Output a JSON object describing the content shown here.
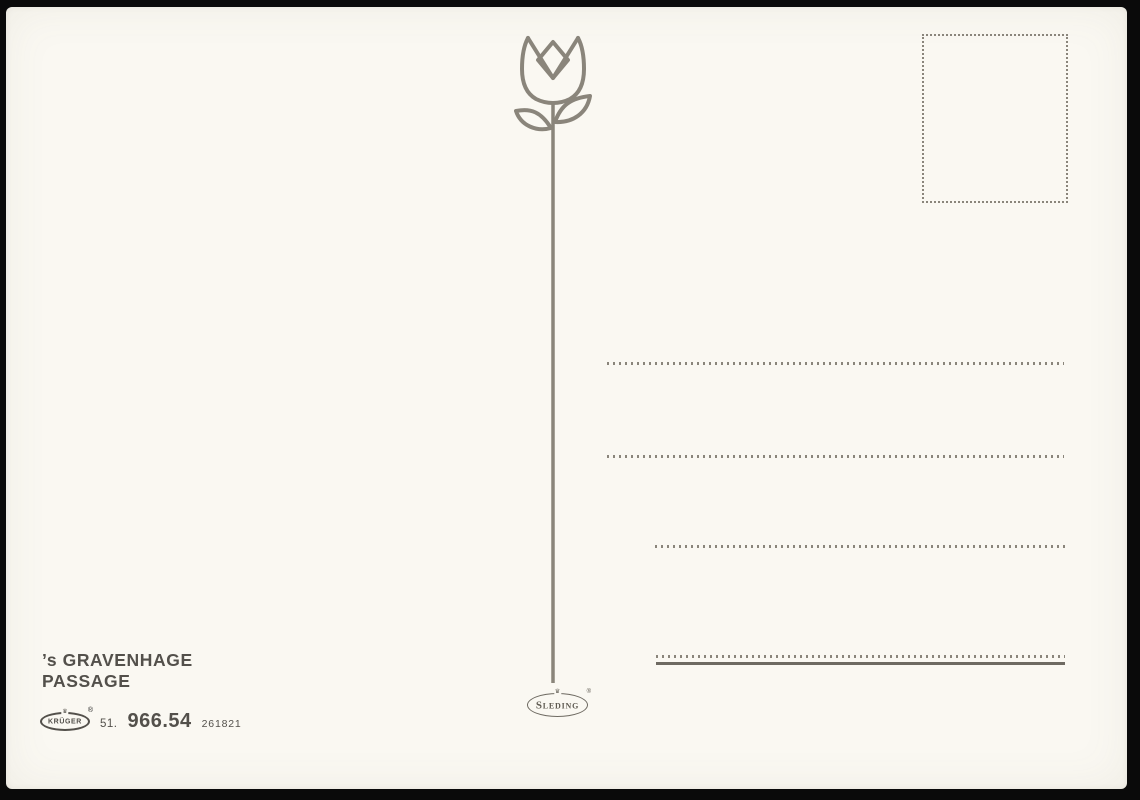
{
  "postcard": {
    "caption": {
      "line1": "’s GRAVENHAGE",
      "line2": "PASSAGE"
    },
    "publisher": {
      "brand": "KRÜGER",
      "registered_mark": "®",
      "crown": "♛",
      "code_prefix": "51.",
      "code_main": "966.54",
      "code_suffix": "261821"
    },
    "printer": {
      "brand": "Sleding",
      "registered_mark": "®",
      "crown": "♛"
    },
    "address_line_count": "4",
    "colors": {
      "background": "#0a0a0a",
      "card_bg": "#faf8f2",
      "outline": "#8a857b",
      "ink": "#53504b",
      "solid_line": "#6e6a62"
    }
  }
}
